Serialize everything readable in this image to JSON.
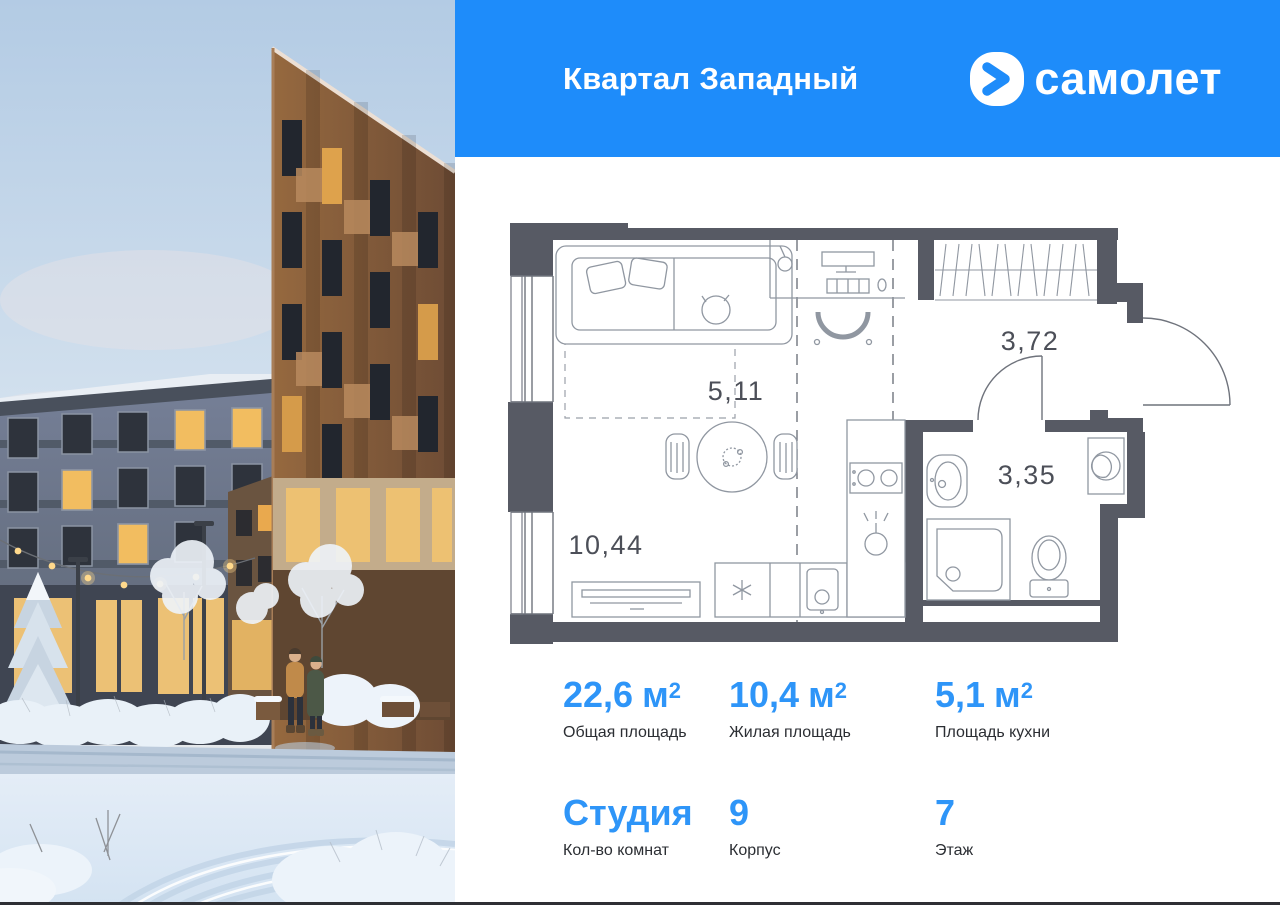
{
  "header": {
    "title": "Квартал Западный",
    "brand_name": "самолет"
  },
  "floor_plan": {
    "areas": {
      "living": "10,44",
      "kitchen": "5,11",
      "hall": "3,72",
      "bathroom": "3,35"
    }
  },
  "stats": {
    "row1": [
      {
        "value": "22,6",
        "unit": "м",
        "sup": "2",
        "label": "Общая площадь"
      },
      {
        "value": "10,4",
        "unit": "м",
        "sup": "2",
        "label": "Жилая площадь"
      },
      {
        "value": "5,1",
        "unit": "м",
        "sup": "2",
        "label": "Площадь кухни"
      }
    ],
    "row2": [
      {
        "value": "Студия",
        "label": "Кол-во комнат"
      },
      {
        "value": "9",
        "label": "Корпус"
      },
      {
        "value": "7",
        "label": "Этаж"
      }
    ]
  },
  "colors": {
    "header_bg": "#1e8cfa",
    "accent_blue": "#2e95f8",
    "plan_walls": "#575a64",
    "plan_label": "#4c4f58",
    "bottom_bar": "#2e2f34"
  }
}
